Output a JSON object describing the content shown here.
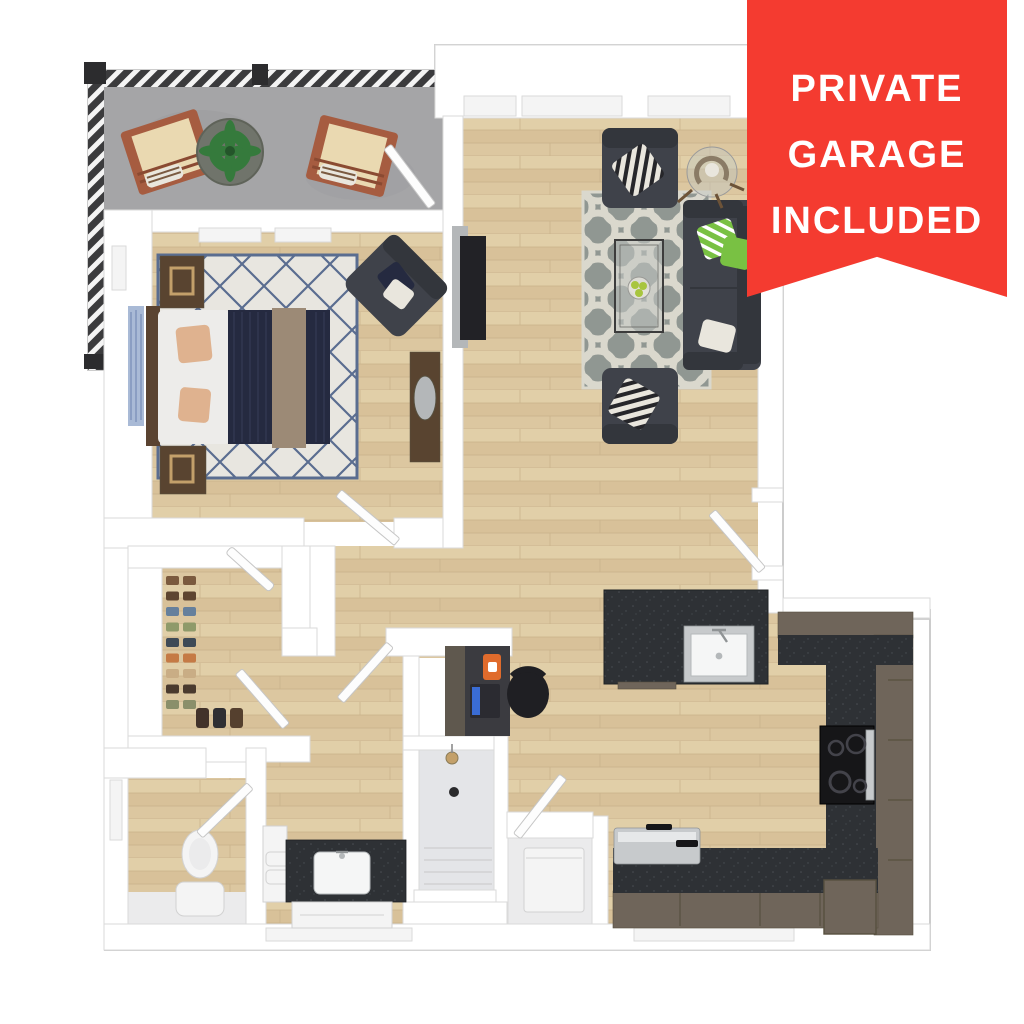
{
  "banner": {
    "lines": [
      "PRIVATE",
      "GARAGE",
      "INCLUDED"
    ],
    "background": "#f43b30",
    "text_color": "#ffffff"
  },
  "palette": {
    "wall": "#ffffff",
    "wall_edge": "#dadada",
    "outline": "#cccccc",
    "seam": "#d2d2d2",
    "window_fill": "#f4f4f4",
    "door": "#fdfdfd",
    "door_edge": "#c6c6c6",
    "wood_a": "#e1cfa8",
    "wood_b": "#d8c199",
    "wood_c": "#dcc7a0",
    "wood_line": "#c9b189",
    "balcony_floor": "#a5a5a7",
    "balcony_shade": "#97979a",
    "railing_dark": "#3b3b3d",
    "railing_slat": "#f4f4f4",
    "railing_post": "#2c2c2e",
    "rug_living": "#909792",
    "rug_living_pattern": "#dad8cd",
    "rug_bed": "#e8e6e0",
    "rug_bed_line": "#5a6d90",
    "sofa": "#3f424a",
    "sofa_dark": "#33363c",
    "pillow_green": "#79c143",
    "pillow_light": "#e9e6dd",
    "chevron_dark": "#26262a",
    "counter": "#2e3135",
    "counter_edge": "#1f2225",
    "counter_speck": "#4a4e54",
    "cabinet": "#6f655a",
    "cabinet_line": "#57503f",
    "steel": "#c7cacc",
    "steel_edge": "#8f9395",
    "steel_hi": "#e6e8e9",
    "black_appliance": "#161618",
    "burner_ring": "#43434a",
    "sink_white": "#f5f6f6",
    "sink_edge": "#b4b8ba",
    "fixture": "#f4f4f4",
    "fixture_edge": "#d2d2d2",
    "shower_floor": "#e4e5e8",
    "tile": "#ebebec",
    "bed_white": "#edecea",
    "bed_navy": "#252a40",
    "bed_navy_line": "#343a55",
    "bed_tan": "#9c8a76",
    "pillow_peach": "#dfb28f",
    "headboard": "#5a4331",
    "nightstand": "#594430",
    "lamp_gold": "#c3a06a",
    "art_blue": "#a9bad6",
    "art_blue_line": "#7e93bb",
    "tv_black": "#222226",
    "media_gray": "#b4b7b9",
    "table_glass": "#c2c7c3",
    "apple_green": "#a8c53e",
    "plant_green": "#357a3c",
    "plant_dark": "#24552a",
    "planter": "#70746b",
    "lounge_wood": "#a65c40",
    "lounge_wood_dark": "#8a4a32",
    "lounge_cushion": "#ead9b1",
    "desk_dark": "#3b3b40",
    "desk_cabinet": "#5f584e",
    "laptop_body": "#2b2b31",
    "laptop_screen": "#3a6cd4",
    "chair_black": "#1f1f23",
    "orange_art": "#e06b2c",
    "banner_bg": "#f43b30",
    "banner_text": "#ffffff"
  },
  "closet": {
    "shoes": [
      "#7b5a3e",
      "#5d4430",
      "#66809c",
      "#8f9a6a",
      "#3f4a56",
      "#c57a45",
      "#c9ad85",
      "#4a3a2e",
      "#8a8f6a"
    ],
    "boots": [
      "#42322a",
      "#2f2f33",
      "#55402e"
    ]
  }
}
